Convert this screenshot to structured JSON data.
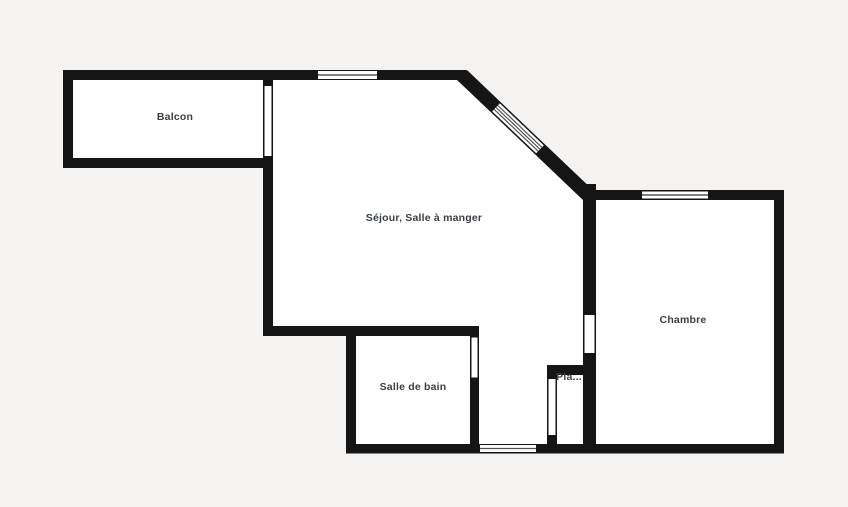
{
  "plan": {
    "type": "floor-plan",
    "colors": {
      "background": "#f4f3f1",
      "wall": "#151515",
      "floor": "#ffffff",
      "label_text": "#3a3f44",
      "window_line": "#555555"
    },
    "rooms": [
      {
        "id": "balcon",
        "label": "Balcon"
      },
      {
        "id": "sejour-salle-a-manger",
        "label": "Séjour, Salle à manger"
      },
      {
        "id": "chambre",
        "label": "Chambre"
      },
      {
        "id": "salle-de-bain",
        "label": "Salle de bain"
      },
      {
        "id": "placard",
        "label": "Pla..."
      }
    ],
    "features": {
      "windows": [
        "window-sejour-top",
        "window-sejour-diagonal",
        "window-chambre-top",
        "window-hall-bottom"
      ],
      "doors": [
        "door-balcon",
        "door-salle-de-bain",
        "door-chambre",
        "door-placard"
      ]
    }
  }
}
